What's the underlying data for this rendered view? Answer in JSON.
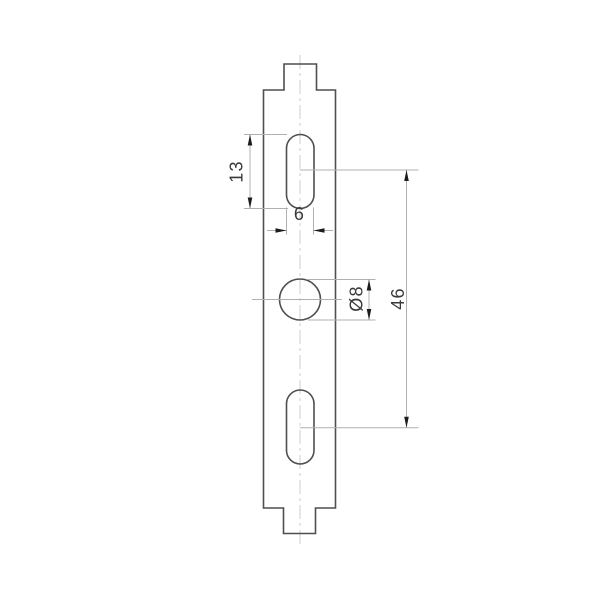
{
  "drawing": {
    "type": "technical-dimension-drawing",
    "part": "mounting-strip-with-slots-and-hole",
    "dimensions": {
      "slot_height": "13",
      "slot_width": "6",
      "hole_diameter": "Ø8",
      "hole_spacing": "46"
    },
    "colors": {
      "background": "#ffffff",
      "outline": "#4f4f4f",
      "dimension_line": "#b0b0b0",
      "centerline": "#d2d2d2",
      "arrow": "#1c1c1c",
      "text": "#3a3a3a"
    }
  }
}
